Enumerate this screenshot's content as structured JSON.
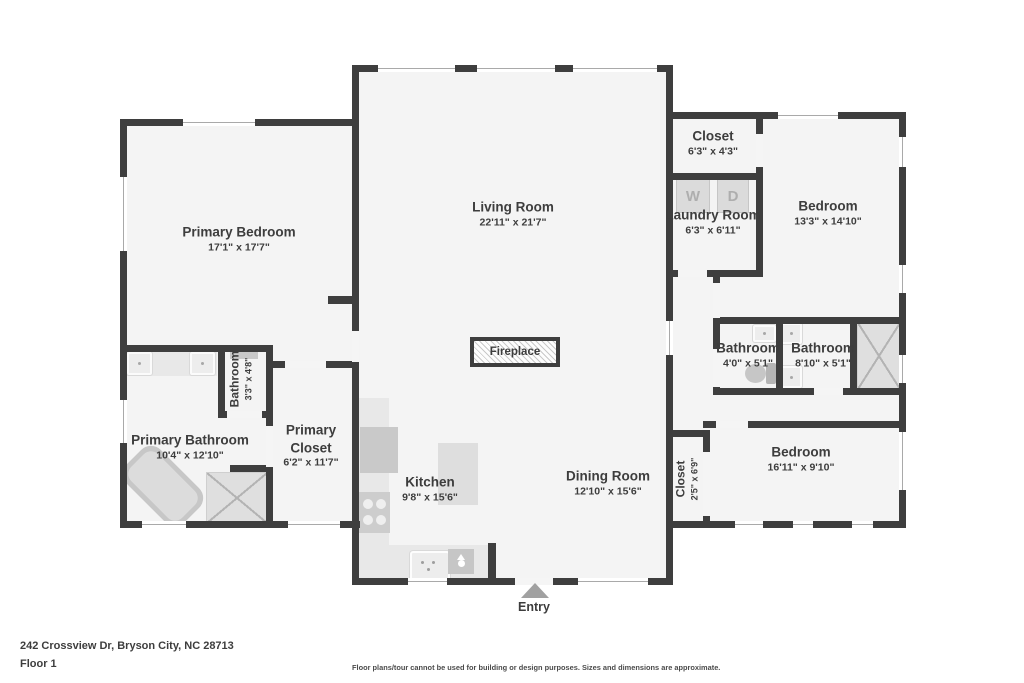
{
  "page": {
    "address": "242 Crossview Dr, Bryson City, NC 28713",
    "floor": "Floor 1",
    "disclaimer": "Floor plans/tour cannot be used for building or design purposes. Sizes and dimensions are approximate.",
    "entry": "Entry"
  },
  "fixtures": {
    "fireplace": "Fireplace",
    "washer": "W",
    "dryer": "D"
  },
  "rooms": [
    {
      "name": "Living Room",
      "dims": "22'11\" x 21'7\""
    },
    {
      "name": "Primary Bedroom",
      "dims": "17'1\" x 17'7\""
    },
    {
      "name": "Closet",
      "dims": "6'3\" x 4'3\""
    },
    {
      "name": "Laundry Room",
      "dims": "6'3\" x 6'11\""
    },
    {
      "name": "Bedroom",
      "dims": "13'3\" x 14'10\""
    },
    {
      "name": "Bathroom",
      "dims": "3'3\" x 4'8\""
    },
    {
      "name": "Primary Bathroom",
      "dims": "10'4\" x 12'10\""
    },
    {
      "name": "Primary Closet",
      "dims": "6'2\" x 11'7\""
    },
    {
      "name": "Bathroom",
      "dims": "4'0\" x 5'1\""
    },
    {
      "name": "Bathroom",
      "dims": "8'10\" x 5'1\""
    },
    {
      "name": "Kitchen",
      "dims": "9'8\" x 15'6\""
    },
    {
      "name": "Dining Room",
      "dims": "12'10\" x 15'6\""
    },
    {
      "name": "Closet",
      "dims": "2'5\" x 6'9\""
    },
    {
      "name": "Bedroom",
      "dims": "16'11\" x 9'10\""
    }
  ],
  "colors": {
    "wall": "#3e3e3e",
    "floor": "#f4f4f4",
    "text": "#3d3d3d",
    "fixture_light": "#e8e8e8",
    "fixture_dark": "#c9c9c9",
    "entry_arrow": "#a1a1a1"
  }
}
